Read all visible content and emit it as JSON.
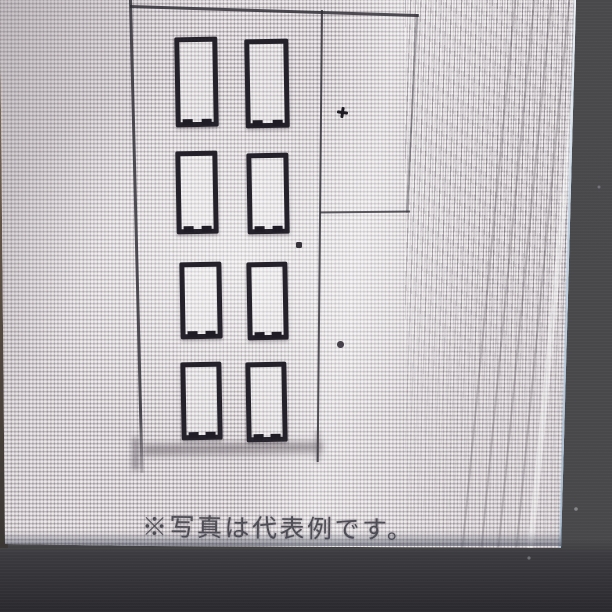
{
  "caption": {
    "text": "※写真は代表例です。"
  },
  "photo": {
    "subject": "line drawing of a tall door panel with eight rectangular openings and a side frame",
    "panel_grid": {
      "rows": 4,
      "columns": 2
    }
  },
  "colors": {
    "screen_background": "#dcd7da",
    "drawing_line": "#2e2b33",
    "caption_text": "#4f4d55",
    "bezel_right": "#4a4a4c",
    "bezel_bottom": "#39383c",
    "screen_edge_highlight": "#bdd3e6",
    "screen_left_edge": "#6b5a4c"
  }
}
